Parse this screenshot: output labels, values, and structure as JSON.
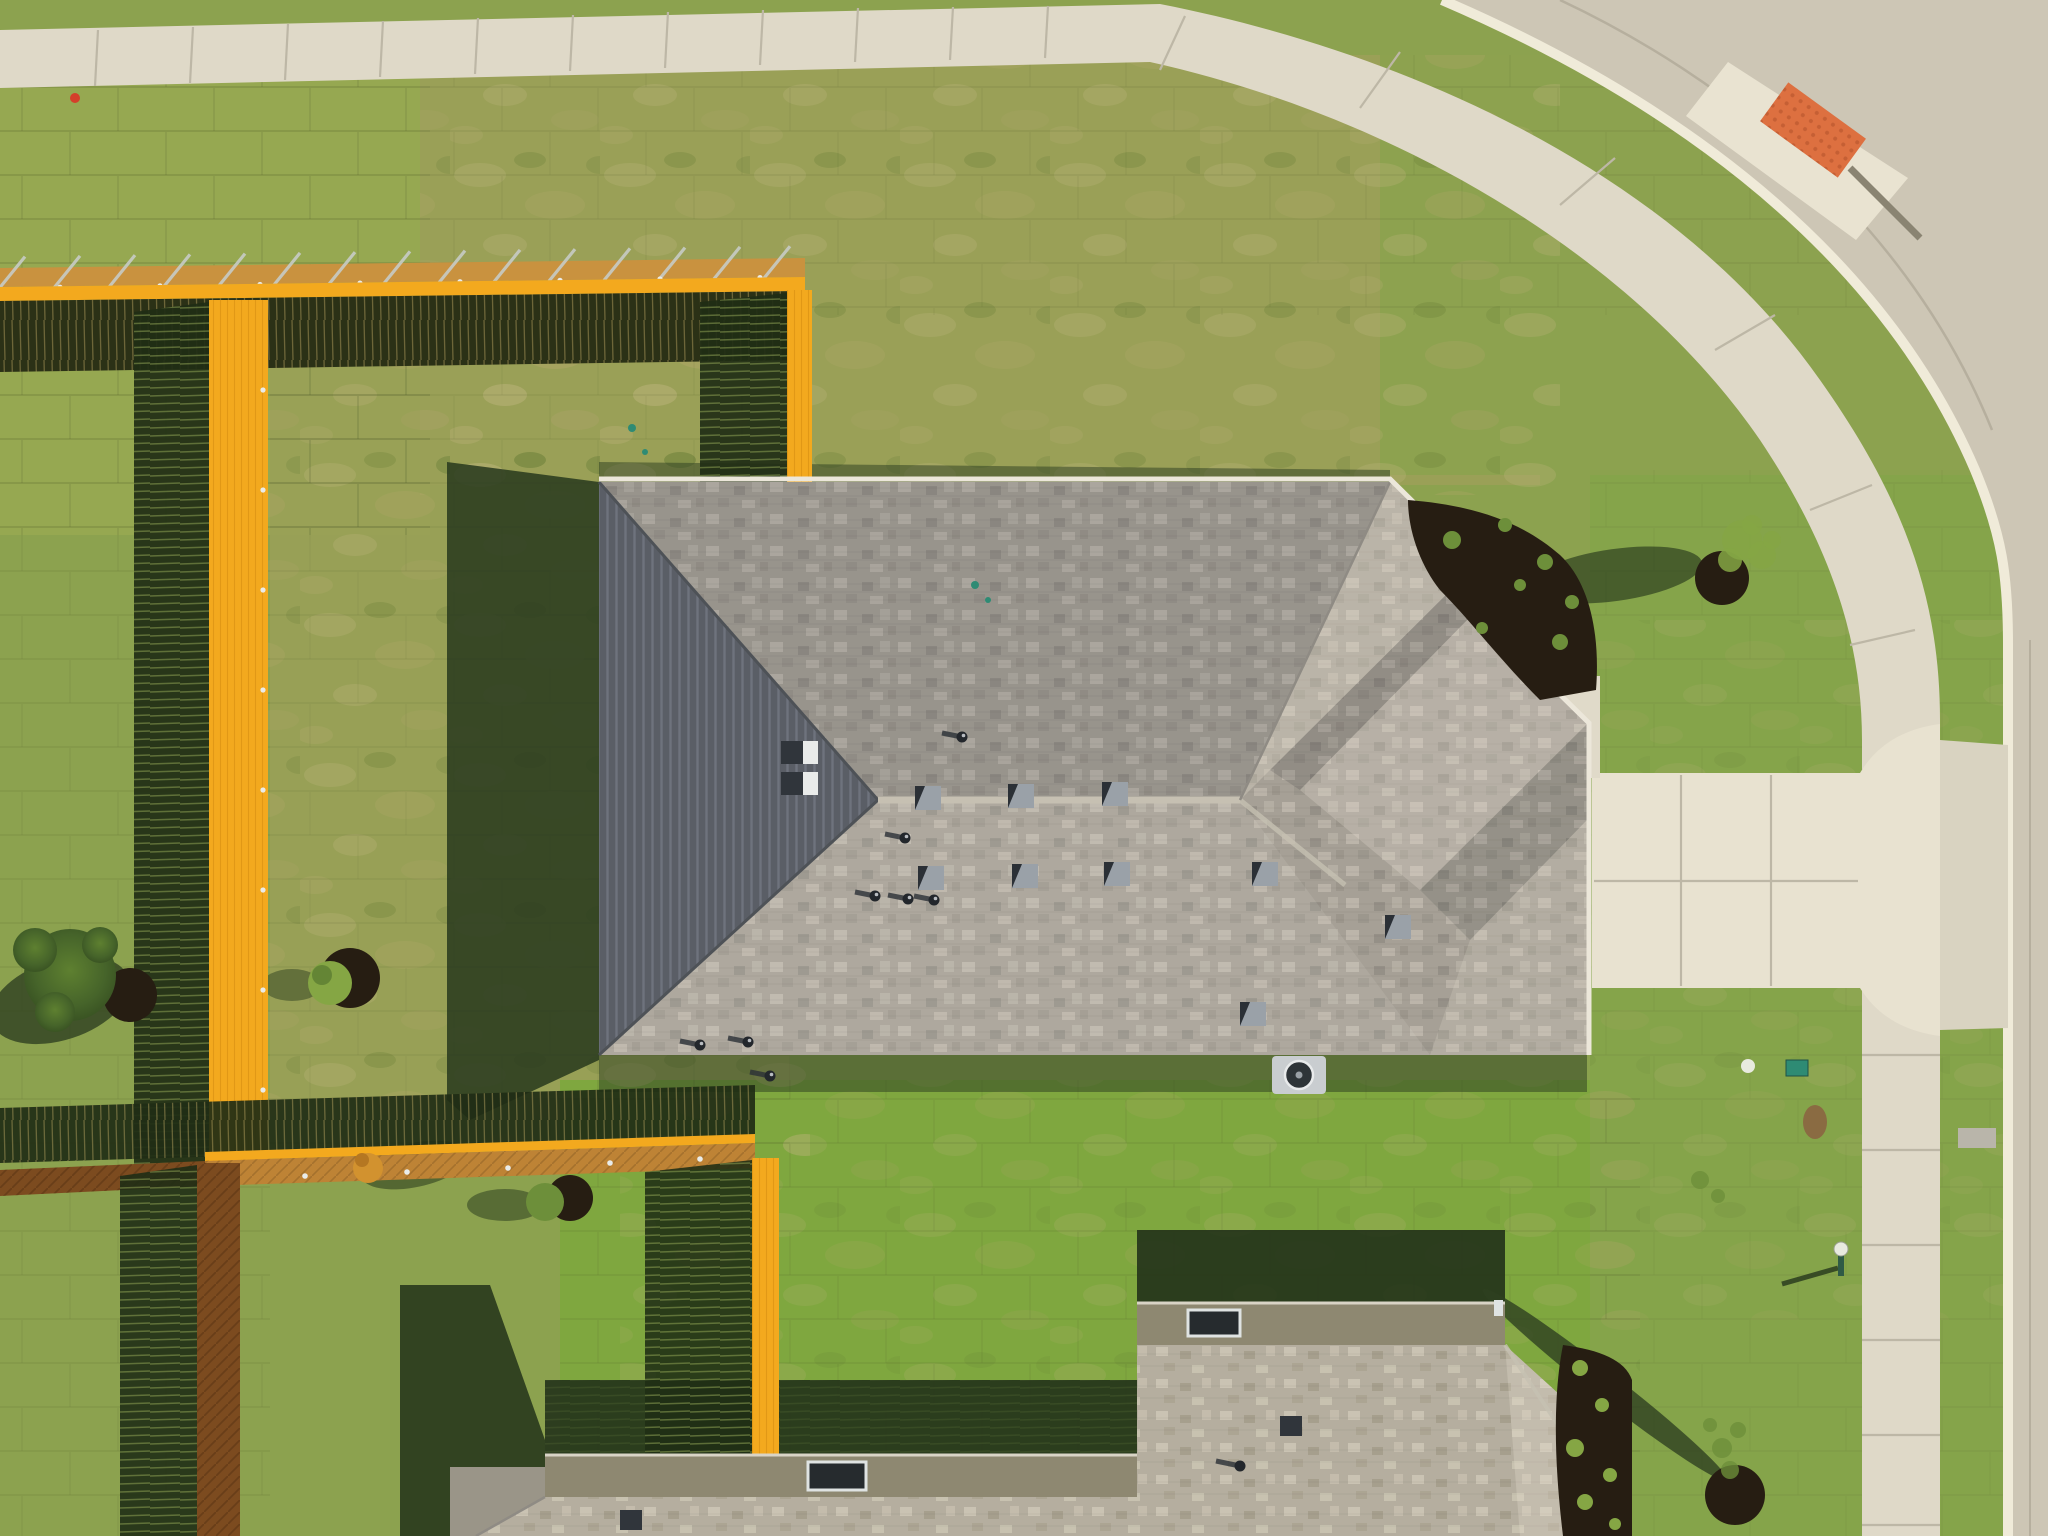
{
  "meta": {
    "title": "Aerial top-down drone photo of a new suburban house",
    "width": 2048,
    "height": 1536
  },
  "scene": {
    "objects": [
      "main-house-hip-roof",
      "second-house-roof",
      "new-cedar-fence-lines",
      "fence-shadows",
      "sod-lawn",
      "curved-sidewalk",
      "street-corner",
      "ada-ramp-mat",
      "driveway",
      "front-walkway",
      "parkway-tree",
      "front-yard-tree",
      "backyard-shrubs",
      "landscape-mulch-beds",
      "ac-unit",
      "yard-lamp",
      "utility-markers"
    ]
  },
  "palette": {
    "grassBase": "#8CA24F",
    "grassTopLeft": "#96A851",
    "grassDry": "#A9A765",
    "grassFresh": "#7FA73F",
    "grassFront": "#85A44A",
    "grassOlive": "#9AA057",
    "shadowFence": "#1F2D15",
    "shadowHouse": "#2A3B1F",
    "shadowTree": "#2E4020",
    "shadowSecondHouse": "#223219",
    "street": "#CDC6B5",
    "streetJoint": "#B6AF9E",
    "curb": "#F0EBD9",
    "sidewalk": "#DFD9C8",
    "sidewalkJoint": "#BDB7A6",
    "driveway": "#E8E2D0",
    "walkway": "#E0DAC9",
    "adaMat": "#DD7040",
    "adaDots": "#C55F34",
    "rampFlare": "#E9E3D1",
    "fenceBright": "#F3A91E",
    "fenceWoodTop": "#C9923F",
    "fenceWoodBottom": "#BE8335",
    "fenceWoodDark": "#7C4B1F",
    "fenceFaceDark": "#2B3116",
    "fenceRail": "#C6CBC5",
    "fenceCap": "#E9ECEA",
    "roofBase": "#A6A096",
    "roofWest": "#5A5E66",
    "roofRidge": "#C6C0B2",
    "roofHipDark": "#4E5257",
    "gutter": "#ECE7DA",
    "roof2Base": "#B5AE9F",
    "wall2": "#8E8871",
    "window": "#262B2E",
    "windowFrame": "#DFE3E2",
    "mulch": "#261D12",
    "plantGreen": "#6D8F3A",
    "plantBright": "#85A644",
    "plantDark": "#4F6F2C",
    "shrubOrange": "#D2922F",
    "acBody": "#C9CDD0",
    "acFan": "#2E3438",
    "patioPad": "#9A9588",
    "tealMarker": "#2E8B74",
    "redMarker": "#D43F2A",
    "lampPole": "#2F5A46",
    "lampGlobe": "#E8EADF",
    "dirtPatch": "#8A6B42",
    "utilityPad": "#B9B5AA"
  },
  "elements": {
    "box_vents": [
      {
        "x": 781,
        "y": 741
      },
      {
        "x": 781,
        "y": 772
      }
    ],
    "square_vents": [
      {
        "x": 915,
        "y": 786
      },
      {
        "x": 1008,
        "y": 784
      },
      {
        "x": 1102,
        "y": 782
      },
      {
        "x": 918,
        "y": 866
      },
      {
        "x": 1012,
        "y": 864
      },
      {
        "x": 1104,
        "y": 862
      },
      {
        "x": 1252,
        "y": 862
      },
      {
        "x": 1385,
        "y": 915
      },
      {
        "x": 1240,
        "y": 1002
      }
    ],
    "pipe_vents": [
      {
        "x": 905,
        "y": 838
      },
      {
        "x": 875,
        "y": 896
      },
      {
        "x": 908,
        "y": 899
      },
      {
        "x": 934,
        "y": 900
      },
      {
        "x": 700,
        "y": 1045
      },
      {
        "x": 748,
        "y": 1042
      },
      {
        "x": 770,
        "y": 1076
      },
      {
        "x": 962,
        "y": 737
      }
    ],
    "second_house_vents": [
      {
        "x": 620,
        "y": 1510
      },
      {
        "x": 1280,
        "y": 1416
      }
    ],
    "second_house_pipes": [
      {
        "x": 1240,
        "y": 1466
      }
    ],
    "rail_ticks": [
      25,
      80,
      135,
      190,
      245,
      300,
      355,
      410,
      465,
      520,
      575,
      630,
      685,
      740,
      790
    ],
    "caps_top_fence": [
      60,
      160,
      260,
      360,
      460,
      560,
      660,
      760
    ],
    "caps_left_fence": [
      390,
      490,
      590,
      690,
      790,
      890,
      990,
      1090
    ],
    "caps_bottom_fence": [
      {
        "x": 220,
        "y": 1180
      },
      {
        "x": 305,
        "y": 1176
      },
      {
        "x": 407,
        "y": 1172
      },
      {
        "x": 508,
        "y": 1168
      },
      {
        "x": 610,
        "y": 1163
      },
      {
        "x": 700,
        "y": 1159
      }
    ],
    "sidewalk_joints": [
      [
        95,
        86,
        98,
        30
      ],
      [
        190,
        83,
        193,
        27
      ],
      [
        285,
        80,
        288,
        24
      ],
      [
        380,
        77,
        383,
        21
      ],
      [
        475,
        74,
        478,
        18
      ],
      [
        570,
        71,
        573,
        15
      ],
      [
        665,
        68,
        668,
        12
      ],
      [
        760,
        65,
        763,
        10
      ],
      [
        855,
        62,
        858,
        8
      ],
      [
        950,
        60,
        953,
        7
      ],
      [
        1045,
        58,
        1048,
        6
      ],
      [
        1160,
        70,
        1185,
        16
      ],
      [
        1360,
        108,
        1400,
        52
      ],
      [
        1560,
        205,
        1615,
        158
      ],
      [
        1715,
        350,
        1775,
        315
      ],
      [
        1810,
        510,
        1872,
        485
      ],
      [
        1850,
        645,
        1915,
        630
      ],
      [
        1862,
        770,
        1940,
        770
      ],
      [
        1862,
        865,
        1940,
        865
      ],
      [
        1862,
        960,
        1940,
        960
      ],
      [
        1862,
        1055,
        1940,
        1055
      ],
      [
        1862,
        1150,
        1940,
        1150
      ],
      [
        1862,
        1245,
        1940,
        1245
      ],
      [
        1862,
        1340,
        1940,
        1340
      ],
      [
        1862,
        1435,
        1940,
        1435
      ],
      [
        1862,
        1525,
        1940,
        1525
      ]
    ],
    "driveway_joints": [
      [
        1681,
        775,
        1681,
        986
      ],
      [
        1771,
        775,
        1771,
        986
      ],
      [
        1594,
        881,
        1858,
        881
      ]
    ],
    "teal_markers": [
      {
        "x": 632,
        "y": 428,
        "r": 4
      },
      {
        "x": 645,
        "y": 452,
        "r": 3
      },
      {
        "x": 975,
        "y": 585,
        "r": 4
      },
      {
        "x": 988,
        "y": 600,
        "r": 3
      }
    ],
    "ne_bed_plants": [
      {
        "x": 1452,
        "y": 540,
        "r": 9
      },
      {
        "x": 1505,
        "y": 525,
        "r": 7
      },
      {
        "x": 1545,
        "y": 562,
        "r": 8
      },
      {
        "x": 1572,
        "y": 602,
        "r": 7
      },
      {
        "x": 1560,
        "y": 642,
        "r": 8
      },
      {
        "x": 1520,
        "y": 585,
        "r": 6
      },
      {
        "x": 1482,
        "y": 628,
        "r": 6
      }
    ],
    "east_bed_plants": [
      {
        "x": 1580,
        "y": 1368,
        "r": 8
      },
      {
        "x": 1602,
        "y": 1405,
        "r": 7
      },
      {
        "x": 1575,
        "y": 1448,
        "r": 9
      },
      {
        "x": 1610,
        "y": 1475,
        "r": 7
      },
      {
        "x": 1585,
        "y": 1502,
        "r": 8
      },
      {
        "x": 1615,
        "y": 1524,
        "r": 6
      }
    ],
    "parkway_canopy": [
      {
        "x": 1742,
        "y": 540,
        "r": 20
      },
      {
        "x": 1762,
        "y": 555,
        "r": 14
      },
      {
        "x": 1730,
        "y": 560,
        "r": 12
      },
      {
        "x": 1752,
        "y": 525,
        "r": 10
      },
      {
        "x": 1772,
        "y": 540,
        "r": 9
      }
    ],
    "front_tree_canopy": [
      {
        "x": 1722,
        "y": 1448,
        "r": 10
      },
      {
        "x": 1738,
        "y": 1430,
        "r": 8
      },
      {
        "x": 1710,
        "y": 1425,
        "r": 7
      },
      {
        "x": 1730,
        "y": 1470,
        "r": 9
      },
      {
        "x": 1700,
        "y": 1180,
        "r": 9
      },
      {
        "x": 1718,
        "y": 1196,
        "r": 7
      }
    ]
  }
}
